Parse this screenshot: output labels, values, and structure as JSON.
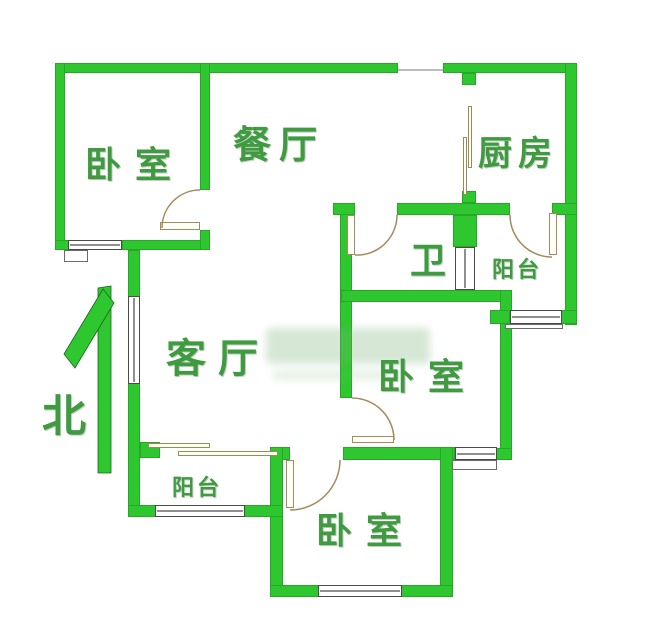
{
  "title": "户型图",
  "colors": {
    "wall_green": "#2fc72f",
    "label_green": "#3f9b3f",
    "door_tan": "#a38b5c",
    "window_gray": "#4a4a4a"
  },
  "compass": {
    "label": "北"
  },
  "rooms": [
    {
      "name": "bedroom-top-left",
      "label": "卧室"
    },
    {
      "name": "dining-room",
      "label": "餐厅"
    },
    {
      "name": "kitchen",
      "label": "厨房"
    },
    {
      "name": "bathroom",
      "label": "卫"
    },
    {
      "name": "balcony-right",
      "label": "阳台"
    },
    {
      "name": "living-room",
      "label": "客厅"
    },
    {
      "name": "bedroom-mid-right",
      "label": "卧室"
    },
    {
      "name": "balcony-bottom-left",
      "label": "阳台"
    },
    {
      "name": "bedroom-bottom",
      "label": "卧室"
    }
  ]
}
